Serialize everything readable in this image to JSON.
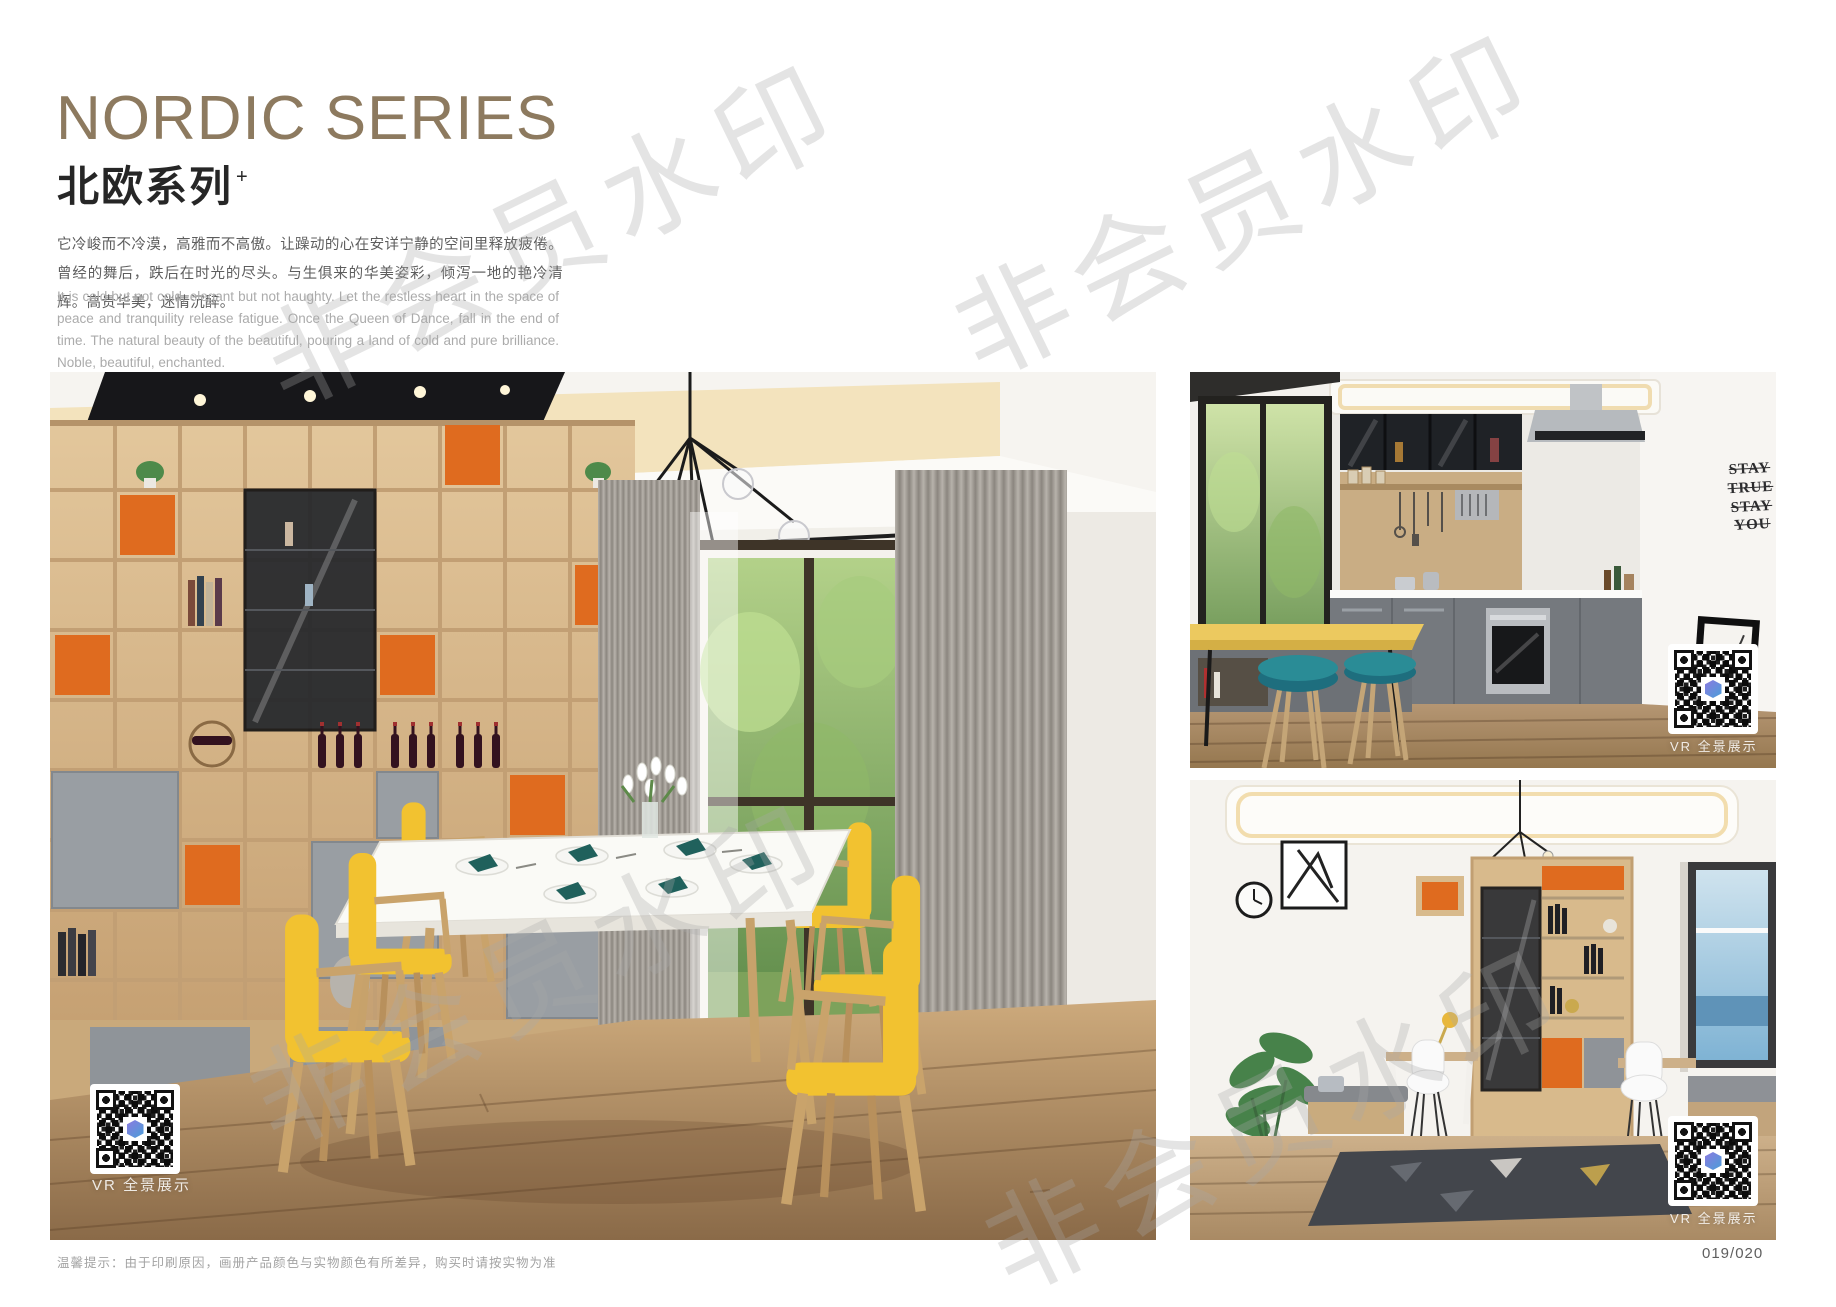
{
  "page": {
    "footer_note": "温馨提示：由于印刷原因，画册产品颜色与实物颜色有所差异，购买时请按实物为准",
    "page_number": "019/020"
  },
  "header": {
    "title_en": "NORDIC SERIES",
    "title_cn": "北欧系列",
    "title_sup": "+",
    "desc_cn": "它冷峻而不冷漠，高雅而不高傲。让躁动的心在安详宁静的空间里释放疲倦。曾经的舞后，跌后在时光的尽头。与生俱来的华美姿彩，倾泻一地的艳冷清辉。高贵华美，迷情沉醉。",
    "desc_en": "It is cold but not cold, elegant but not haughty. Let the restless heart in the space of peace and tranquility release fatigue. Once the Queen of Dance, fall in the end of time. The natural beauty of the beautiful, pouring a land of cold and pure brilliance. Noble, beautiful, enchanted."
  },
  "watermark": {
    "text": "非会员水印"
  },
  "photos": {
    "dining": {
      "vr_label": "VR 全景展示"
    },
    "kitchen": {
      "vr_label": "VR 全景展示",
      "wall_text": [
        "STAY",
        "TRUE",
        "STAY",
        "YOU"
      ]
    },
    "study": {
      "vr_label": "VR 全景展示"
    }
  },
  "colors": {
    "title": "#8d7a5f",
    "accent_orange": "#df6b1f",
    "chair_yellow": "#f2c230",
    "stool_teal": "#2a8c96",
    "qr_logo_a": "#8a79e0",
    "qr_logo_b": "#4a9fd8"
  }
}
